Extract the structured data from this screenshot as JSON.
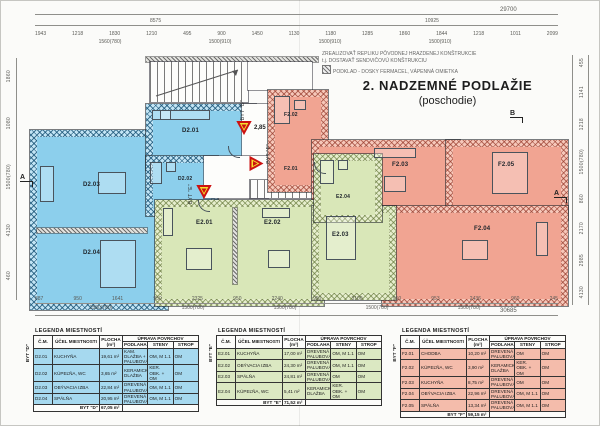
{
  "title": {
    "line1": "2. NADZEMNÉ PODLAŽIE",
    "line2": "(poschodie)"
  },
  "notes": {
    "line1": "ZREALIZOVAŤ REPLIKU PÔVODNEJ HRAZDENEJ KONŠTRUKCIE",
    "line2": "t.j. DOSTAVAŤ SENDVIČOVÚ KONŠTRUKCIU",
    "line3": "PODKLAD - DOSKY FERMACEL, VÁPENNÁ OMIETKA"
  },
  "plan": {
    "rooms": {
      "d201": "D2.01",
      "d202": "D2.02",
      "d203": "D2.03",
      "d204": "D2.04",
      "e201": "E2.01",
      "e202": "E2.02",
      "e203": "E2.03",
      "e204": "E2.04",
      "f201": "F2.01",
      "f202": "F2.02",
      "f203": "F2.03",
      "f204": "F2.04",
      "f205": "F2.05"
    }
  },
  "markers": {
    "elevation": "2,85",
    "byt_d": "BYT \"D\"",
    "byt_e": "BYT \"E\"",
    "byt_f": "BYT \"F\"",
    "section_a": "A",
    "section_b": "B"
  },
  "dims": {
    "top_overall": "29700",
    "top_left_span": "8575",
    "top_right_span": "10925",
    "top_chain": [
      "1943",
      "1218",
      "1830",
      "1210",
      "495",
      "900",
      "1450",
      "1130",
      "1180",
      "1285",
      "1860",
      "1844",
      "1218",
      "1011",
      "2099"
    ],
    "top_sub": [
      "1560(780)",
      "1500(910)",
      "1500(910)",
      "1500(910)"
    ],
    "bottom_chain": [
      "887",
      "950",
      "1641",
      "950",
      "2325",
      "950",
      "2240",
      "950",
      "3100",
      "950",
      "953",
      "2436",
      "960",
      "245"
    ],
    "bottom_sub": [
      "1580(780)",
      "1500(780)",
      "1500(780)",
      "1500(780)",
      "1500(780)"
    ],
    "bottom_overall": "30685",
    "left_chain": [
      "1860",
      "1080",
      "1500(780)",
      "4130",
      "460"
    ],
    "right_chain": [
      "455",
      "1141",
      "1218",
      "1500(780)",
      "860",
      "2170",
      "2985",
      "4130"
    ]
  },
  "legends": [
    {
      "group": "BYT \"D\"",
      "title": "LEGENDA MIESTNOSTÍ",
      "headers": {
        "cm": "Č.M.",
        "name": "ÚČEL MIESTNOSTI",
        "area": "PLOCHA (m²)",
        "surfaces": "ÚPRAVA POVRCHOV",
        "floor": "PODLAHA",
        "walls": "STENY",
        "ceiling": "STROP"
      },
      "rows": [
        {
          "cm": "D2.01",
          "name": "KUCHYŇA",
          "area": "19,61 m²",
          "floor": "KAM. DLAŽBA + PALUBOVÁ",
          "walls": "OM, M 1.1",
          "ceiling": "OM"
        },
        {
          "cm": "D2.02",
          "name": "KÚPEĽŇA, WC",
          "area": "3,65 m²",
          "floor": "KERAMICKÁ DLAŽBA",
          "walls": "KER. OBK. + OM",
          "ceiling": "OM"
        },
        {
          "cm": "D2.03",
          "name": "OBÝVACIA IZBA",
          "area": "22,84 m²",
          "floor": "DREVENÁ PALUBOVÁ",
          "walls": "OM, M 1.1",
          "ceiling": "OM"
        },
        {
          "cm": "D2.04",
          "name": "SPÁLŇA",
          "area": "20,95 m²",
          "floor": "DREVENÁ PALUBOVÁ",
          "walls": "OM, M 1.1",
          "ceiling": "OM"
        }
      ],
      "total_label": "BYT \"D\"",
      "total_area": "67,05 m²"
    },
    {
      "group": "BYT \"E\"",
      "title": "LEGENDA MIESTNOSTÍ",
      "headers": {
        "cm": "Č.M.",
        "name": "ÚČEL MIESTNOSTI",
        "area": "PLOCHA (m²)",
        "surfaces": "ÚPRAVA POVRCHOV",
        "floor": "PODLAHA",
        "walls": "STENY",
        "ceiling": "STROP"
      },
      "rows": [
        {
          "cm": "E2.01",
          "name": "KUCHYŇA",
          "area": "17,00 m²",
          "floor": "DREVENÁ PALUBOVÁ",
          "walls": "OM, M 1.1",
          "ceiling": "OM"
        },
        {
          "cm": "E2.02",
          "name": "OBÝVACIA IZBA",
          "area": "24,30 m²",
          "floor": "DREVENÁ PALUBOVÁ",
          "walls": "OM, M 1.1",
          "ceiling": "OM"
        },
        {
          "cm": "E2.03",
          "name": "SPÁLŇA",
          "area": "24,81 m²",
          "floor": "DREVENÁ PALUBOVÁ",
          "walls": "OM",
          "ceiling": "OM"
        },
        {
          "cm": "E2.04",
          "name": "KÚPEĽŇA, WC",
          "area": "5,41 m²",
          "floor": "KERAMICKÁ DLAŽBA",
          "walls": "KER. OBK. + OM",
          "ceiling": "OM"
        }
      ],
      "total_label": "BYT \"E\"",
      "total_area": "71,52 m²"
    },
    {
      "group": "BYT \"F\"",
      "title": "LEGENDA MIESTNOSTÍ",
      "headers": {
        "cm": "Č.M.",
        "name": "ÚČEL MIESTNOSTI",
        "area": "PLOCHA (m²)",
        "surfaces": "ÚPRAVA POVRCHOV",
        "floor": "PODLAHA",
        "walls": "STENY",
        "ceiling": "STROP"
      },
      "rows": [
        {
          "cm": "F2.01",
          "name": "CHODBA",
          "area": "10,20 m²",
          "floor": "DREVENÁ PALUBOVÁ",
          "walls": "OM",
          "ceiling": "OM"
        },
        {
          "cm": "F2.02",
          "name": "KÚPEĽŇA, WC",
          "area": "3,90 m²",
          "floor": "KERAMICKÁ DLAŽBA",
          "walls": "KER. OBK. + OM",
          "ceiling": "OM"
        },
        {
          "cm": "F2.03",
          "name": "KUCHYŇA",
          "area": "8,75 m²",
          "floor": "DREVENÁ PALUBOVÁ",
          "walls": "OM",
          "ceiling": "OM"
        },
        {
          "cm": "F2.04",
          "name": "OBÝVACIA IZBA",
          "area": "22,96 m²",
          "floor": "DREVENÁ PALUBOVÁ",
          "walls": "OM, M 1.1",
          "ceiling": "OM"
        },
        {
          "cm": "F2.05",
          "name": "SPÁLŇA",
          "area": "13,34 m²",
          "floor": "DREVENÁ PALUBOVÁ",
          "walls": "OM, M 1.1",
          "ceiling": "OM"
        }
      ],
      "total_label": "BYT \"F\"",
      "total_area": "59,15 m²"
    }
  ],
  "colors": {
    "apartment_d": "#8ccfec",
    "apartment_e": "#d9e7b8",
    "apartment_f": "#f1a492",
    "marker_red": "#cc1111",
    "marker_yellow": "#f5e12e"
  }
}
